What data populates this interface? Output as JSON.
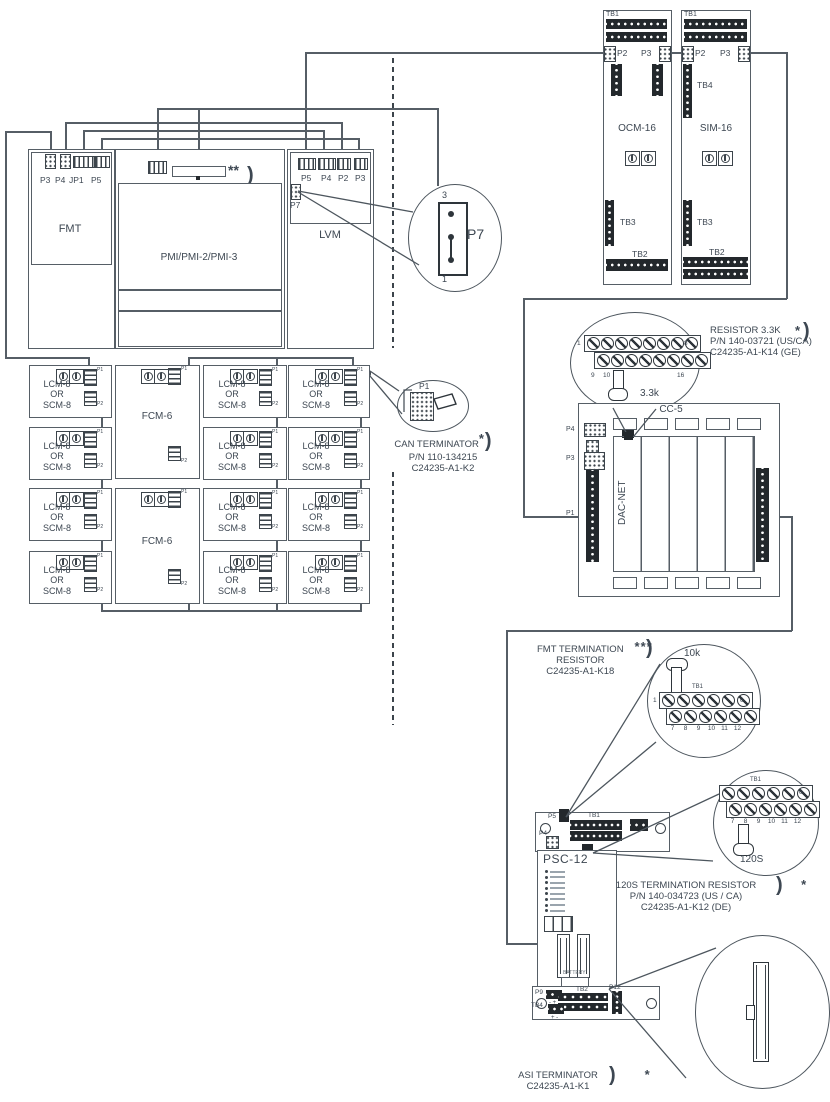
{
  "modules": {
    "fmt": {
      "label": "FMT",
      "p3": "P3",
      "p4": "P4",
      "jp1": "JP1",
      "p5": "P5"
    },
    "pmi": {
      "label": "PMI/PMI-2/PMI-3",
      "star": "**",
      "paren": ")"
    },
    "lvm": {
      "label": "LVM",
      "p5": "P5",
      "p4": "P4",
      "p2": "P2",
      "p3": "P3",
      "p7": "P7"
    },
    "ocm": {
      "label": "OCM-16",
      "tb1": "TB1",
      "p2": "P2",
      "p3": "P3",
      "tb3": "TB3",
      "tb2": "TB2"
    },
    "sim": {
      "label": "SIM-16",
      "tb1": "TB1",
      "p2": "P2",
      "p3": "P3",
      "tb4": "TB4",
      "tb3": "TB3",
      "tb2": "TB2"
    },
    "cc5": {
      "label": "CC-5",
      "p4": "P4",
      "p3": "P3",
      "p1": "P1",
      "slot": "DAC-NET"
    },
    "psc12": {
      "label": "PSC-12",
      "p5": "P5",
      "tb1": "TB1",
      "p4": "P4",
      "battery": "BATTERY",
      "p9": "P9",
      "tb2": "TB2",
      "p12": "P12",
      "tb4": "TB4",
      "p9_pol": "- +",
      "tb4_pol": "+ -"
    },
    "grid": {
      "lcm1": "LCM-8",
      "lcm2": "OR",
      "lcm3": "SCM-8",
      "fcm": "FCM-6",
      "p1": "P1",
      "p2": "P2"
    }
  },
  "callouts": {
    "p7": {
      "pin_top": "3",
      "pin_bottom": "1",
      "label": "P7"
    },
    "can": {
      "port": "P1",
      "title": "CAN TERMINATOR",
      "star": "*",
      "paren": ")",
      "pn": "P/N 110-134215",
      "kit": "C24235-A1-K2"
    },
    "r33k": {
      "title": "RESISTOR 3.3K",
      "star": "*",
      "paren": ")",
      "pn": "P/N 140-03721 (US/CA)",
      "kit": "C24235-A1-K14 (GE)",
      "value": "3.3k",
      "t1": "1",
      "t8": "8",
      "t9": "9",
      "t10": "10",
      "t16": "16"
    },
    "fmt_term": {
      "line1": "FMT TERMINATION",
      "star": "***",
      "paren": ")",
      "line2": "RESISTOR",
      "kit": "C24235-A1-K18",
      "value": "10k",
      "tb": "TB1",
      "t1": "1",
      "t6": "6",
      "nums": [
        "7",
        "8",
        "9",
        "10",
        "11",
        "12"
      ]
    },
    "r120": {
      "title": "120S TERMINATION RESISTOR",
      "star": "*",
      "paren": ")",
      "pn": "P/N 140-034723 (US / CA)",
      "kit": "C24235-A1-K12 (DE)",
      "value": "120S",
      "tb": "TB1",
      "t6": "6",
      "nums": [
        "7",
        "8",
        "9",
        "10",
        "11",
        "12"
      ]
    },
    "asi": {
      "title": "ASI TERMINATOR",
      "star": "*",
      "paren": ")",
      "kit": "C24235-A1-K1"
    }
  },
  "counts": {
    "screws8": 8,
    "screws6": 6,
    "cc5_tabs": 5,
    "leds": 8
  }
}
